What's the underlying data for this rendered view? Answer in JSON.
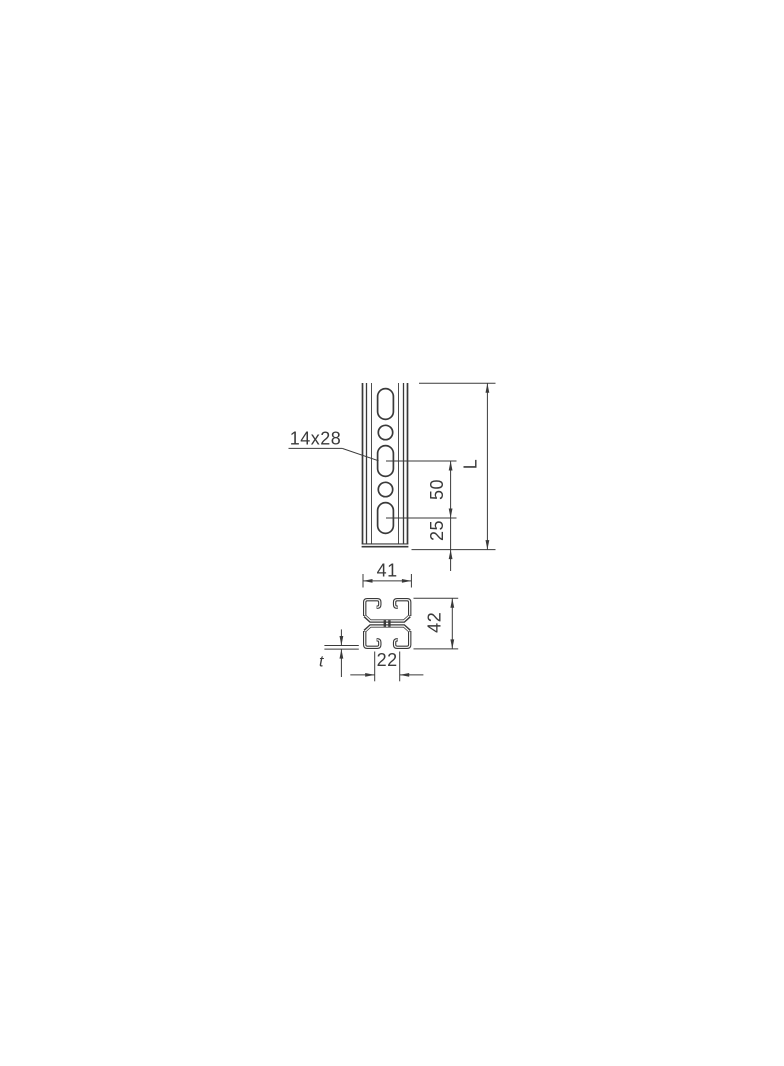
{
  "drawing": {
    "line_color": "#3a3a3a",
    "background": "#ffffff",
    "front_view": {
      "slot_label": "14x28",
      "pitch_dim": "50",
      "end_offset_dim": "25",
      "length_dim": "L"
    },
    "section_view": {
      "width_dim": "41",
      "height_dim": "42",
      "opening_dim": "22",
      "thickness_dim": "t"
    }
  }
}
